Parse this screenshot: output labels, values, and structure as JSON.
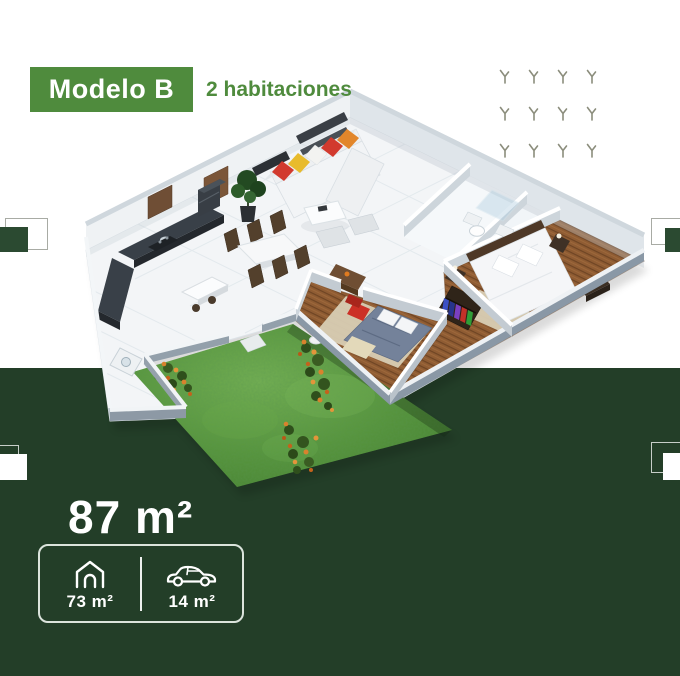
{
  "badge": {
    "label": "Modelo B"
  },
  "subtitle": "2 habitaciones",
  "summary": {
    "total_area": "87 m²"
  },
  "specs": [
    {
      "icon": "house-icon",
      "value": "73 m²"
    },
    {
      "icon": "car-icon",
      "value": "14 m²"
    }
  ],
  "floorplan": {
    "alt": "3D isometric cutaway floor plan with kitchen, dining area, living room with colorful sofa, two bathrooms, two bedrooms with wood floors and a green garden with orange flowers"
  },
  "colors": {
    "brand_green": "#4f8b3d",
    "dark_green": "#233e28",
    "deco_green": "#2b4a31",
    "sprig": "#8b8d7c",
    "white": "#ffffff"
  }
}
